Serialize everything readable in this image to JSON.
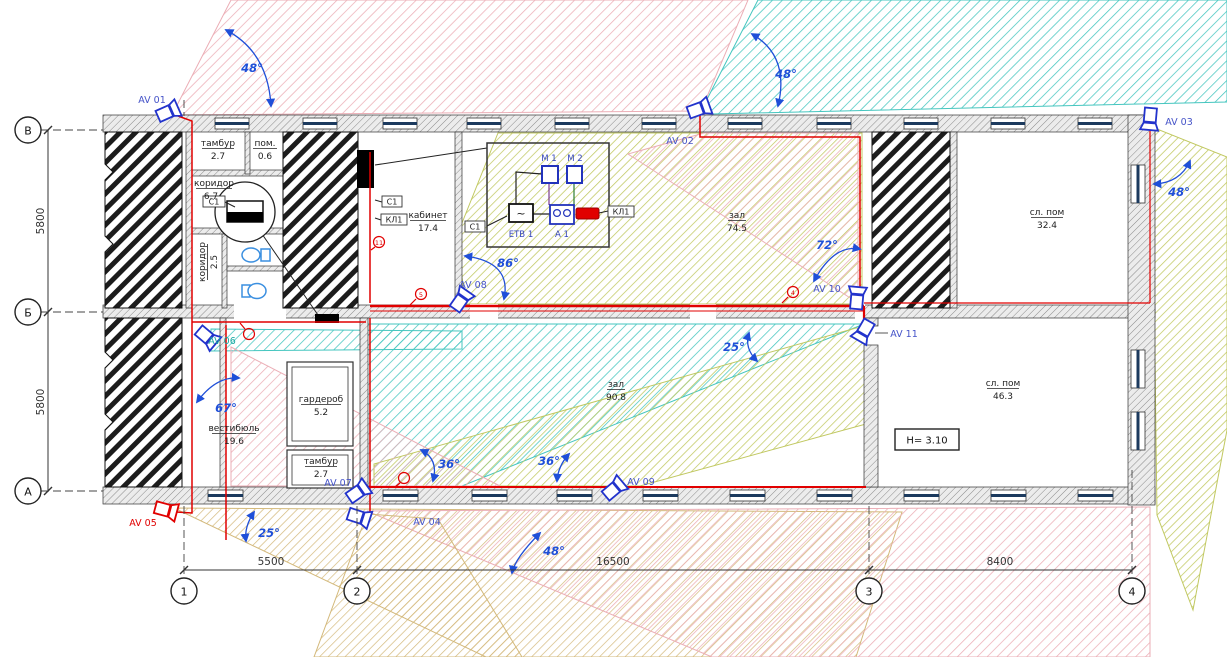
{
  "plan": {
    "axes_rows": [
      "В",
      "Б",
      "А"
    ],
    "axes_cols": [
      "1",
      "2",
      "3",
      "4"
    ],
    "dims_v": [
      "5800",
      "5800"
    ],
    "dims_h": [
      "5500",
      "16500",
      "8400"
    ],
    "rooms": [
      {
        "name": "тамбур",
        "area": "2.7"
      },
      {
        "name": "пом.",
        "area": "0.6"
      },
      {
        "name": "коридор",
        "area": "6.7"
      },
      {
        "name": "коридор",
        "area": "2.5"
      },
      {
        "name": "кабинет",
        "area": "17.4"
      },
      {
        "name": "зал",
        "area": "74.5"
      },
      {
        "name": "сл. пом",
        "area": "32.4"
      },
      {
        "name": "вестибюль",
        "area": "19.6"
      },
      {
        "name": "гардероб",
        "area": "5.2"
      },
      {
        "name": "тамбур",
        "area": "2.7"
      },
      {
        "name": "зал",
        "area": "90.8"
      },
      {
        "name": "сл. пом",
        "area": "46.3"
      }
    ],
    "cameras": [
      {
        "id": "AV 01"
      },
      {
        "id": "AV 02"
      },
      {
        "id": "AV 03"
      },
      {
        "id": "AV 04"
      },
      {
        "id": "AV 05"
      },
      {
        "id": "AV 06"
      },
      {
        "id": "AV 07"
      },
      {
        "id": "AV 08"
      },
      {
        "id": "AV 09"
      },
      {
        "id": "AV 10"
      },
      {
        "id": "AV 11"
      }
    ],
    "angles": [
      "48°",
      "48°",
      "48°",
      "86°",
      "72°",
      "67°",
      "25°",
      "36°",
      "36°",
      "25°",
      "48°"
    ],
    "equipment": {
      "m1": "М 1",
      "m2": "М 2",
      "etb": "ЕТВ 1",
      "a1": "А 1",
      "kl1": "КЛ1",
      "c1": "С1"
    },
    "markers": {
      "m1": "11",
      "m2": "5",
      "m3": "4"
    },
    "height_note": "H= 3.10"
  }
}
